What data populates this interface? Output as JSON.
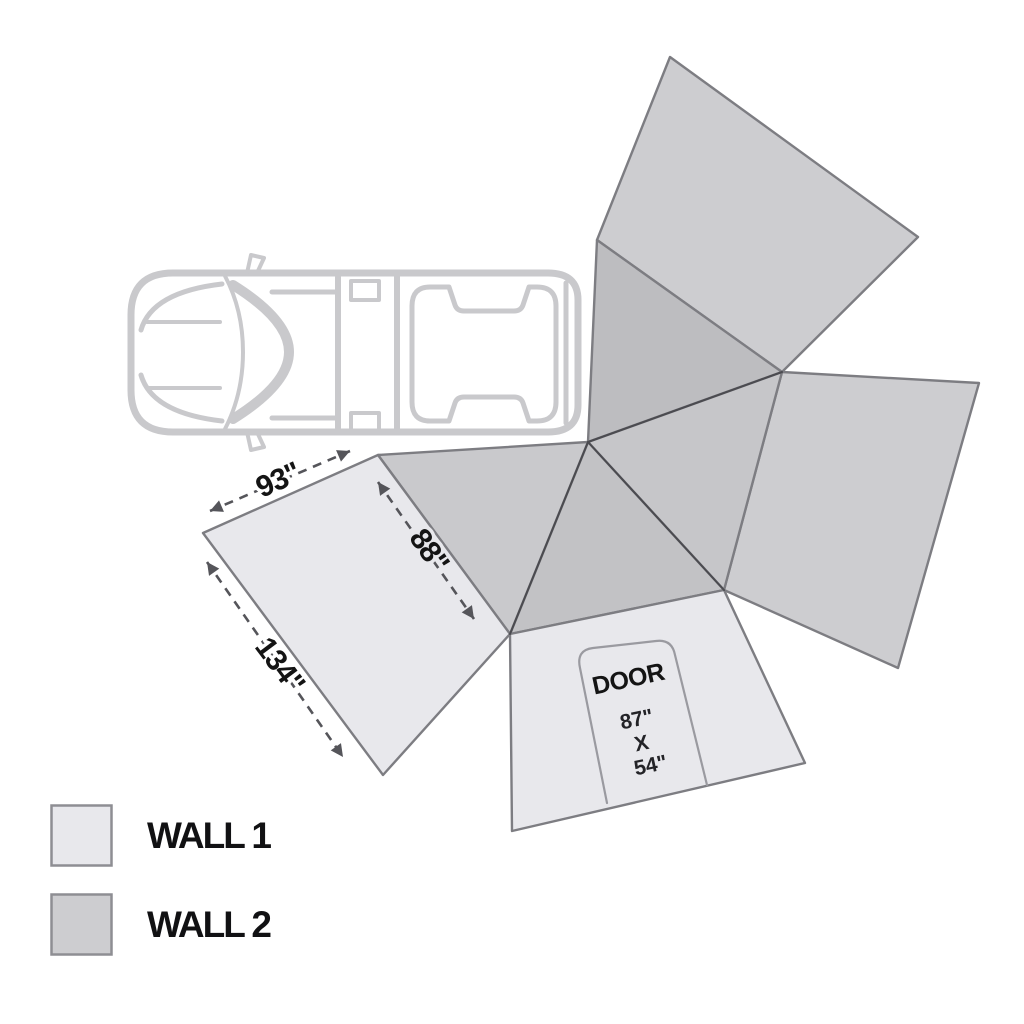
{
  "diagram": {
    "title": "270 awning wall layout diagram",
    "dimensions": {
      "edge_top": "93\"",
      "edge_left": "134\"",
      "edge_inner": "88\""
    },
    "door": {
      "label": "DOOR",
      "height": "87\"",
      "by": "X",
      "width": "54\""
    },
    "colors": {
      "wall1": "#e8e8ec",
      "wall2": "#cdcdd0",
      "awning_t1": "#bdbdc0",
      "awning_t2": "#c6c6c9",
      "awning_t3": "#c2c2c5",
      "awning_t4": "#c9c9cc",
      "panel_outline": "#7d7d82",
      "crease": "#4b4b50",
      "dimension": "#55555a",
      "door_outline": "#9a9aa0",
      "truck": "#c9c9cc",
      "text": "#141414",
      "background": "#ffffff"
    }
  },
  "legend": {
    "items": [
      {
        "label": "WALL 1",
        "color": "#e8e8ec"
      },
      {
        "label": "WALL 2",
        "color": "#cdcdd0"
      }
    ]
  }
}
